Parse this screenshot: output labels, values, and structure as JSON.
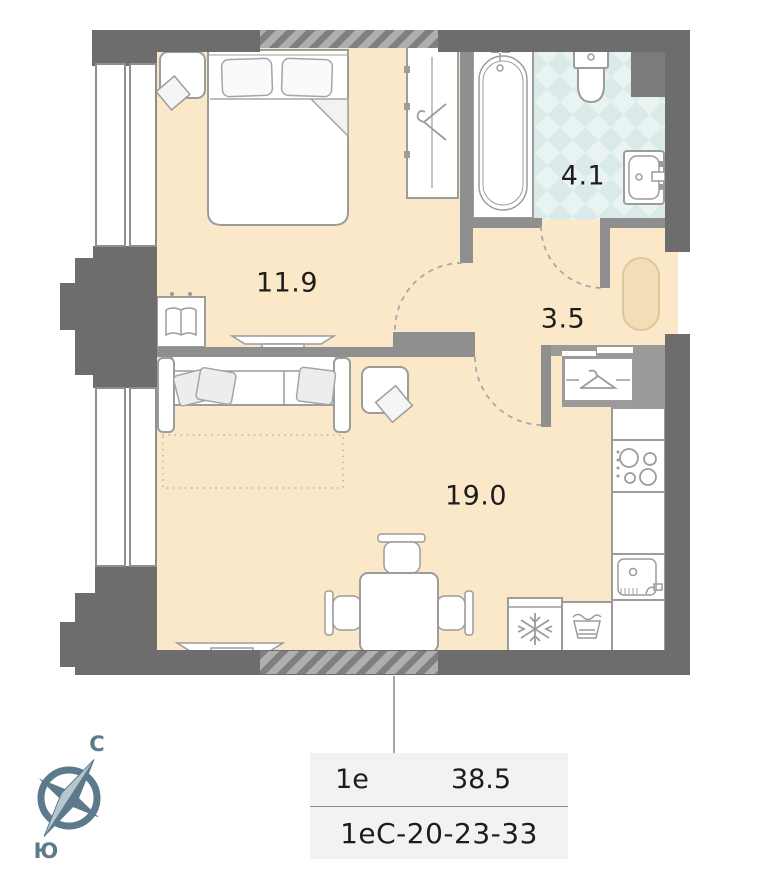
{
  "floorplan": {
    "rooms": [
      {
        "name": "bedroom",
        "area": "11.9"
      },
      {
        "name": "bathroom",
        "area": "4.1"
      },
      {
        "name": "hallway",
        "area": "3.5"
      },
      {
        "name": "living-kitchen",
        "area": "19.0"
      }
    ],
    "compass": {
      "north_label": "С",
      "south_label": "Ю"
    },
    "info_card": {
      "layout_type": "1е",
      "total_area": "38.5",
      "unit_code": "1еС-20-23-33"
    },
    "colors": {
      "floor": "#fbe8c9",
      "tile": "#dcebe9",
      "wall_dark": "#6d6d6d",
      "wall_partition": "#8f8f8f",
      "hall_rug": "#f1ddb6",
      "compass_accent": "#5d7a8a",
      "card_background": "#f2f2f2"
    }
  }
}
